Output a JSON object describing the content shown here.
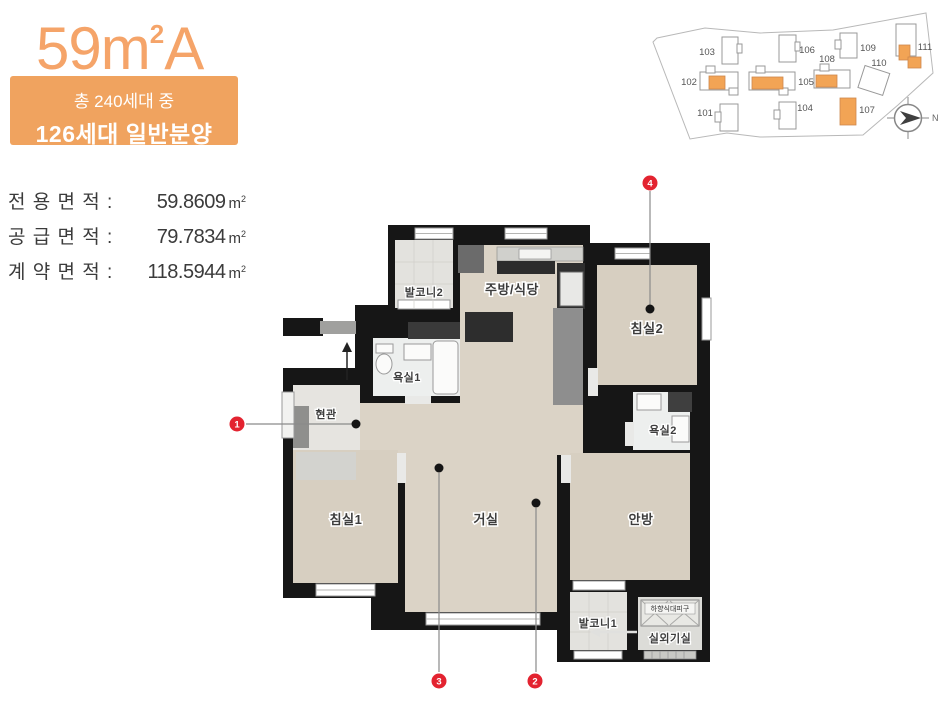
{
  "colors": {
    "accent_orange": "#f5a469",
    "badge_orange": "#f0a35f",
    "marker_red": "#e32330",
    "site_orange": "#f2a455"
  },
  "header": {
    "title_number": "59",
    "title_unit_base": "m",
    "title_unit_sup": "2",
    "title_letter": "A",
    "badge_line1": "총 240세대 중",
    "badge_line2": "126세대 일반분양"
  },
  "areas": {
    "unit_base": "m",
    "unit_sup": "2",
    "rows": [
      {
        "label": "전 용 면 적 :",
        "value": "59.8609"
      },
      {
        "label": "공 급 면 적 :",
        "value": "79.7834"
      },
      {
        "label": "계 약 면 적 :",
        "value": "118.5944"
      }
    ]
  },
  "site_plan": {
    "compass_label": "N",
    "buildings": [
      {
        "id": "101",
        "highlighted": false
      },
      {
        "id": "102",
        "highlighted": true
      },
      {
        "id": "103",
        "highlighted": false
      },
      {
        "id": "104",
        "highlighted": false
      },
      {
        "id": "105",
        "highlighted": true
      },
      {
        "id": "106",
        "highlighted": false
      },
      {
        "id": "107",
        "highlighted": true
      },
      {
        "id": "108",
        "highlighted": true
      },
      {
        "id": "109",
        "highlighted": false
      },
      {
        "id": "110",
        "highlighted": false
      },
      {
        "id": "111",
        "highlighted": true
      }
    ]
  },
  "floor_plan": {
    "rooms": {
      "balcony2": "발코니2",
      "kitchen": "주방/식당",
      "bedroom2": "침실2",
      "bath1": "욕실1",
      "entry": "현관",
      "bath2": "욕실2",
      "bedroom1": "침실1",
      "living": "거실",
      "master": "안방",
      "balcony1": "발코니1",
      "machine": "실외기실",
      "evac": "하향식대피구"
    },
    "markers": [
      {
        "n": "1"
      },
      {
        "n": "2"
      },
      {
        "n": "3"
      },
      {
        "n": "4"
      }
    ]
  }
}
